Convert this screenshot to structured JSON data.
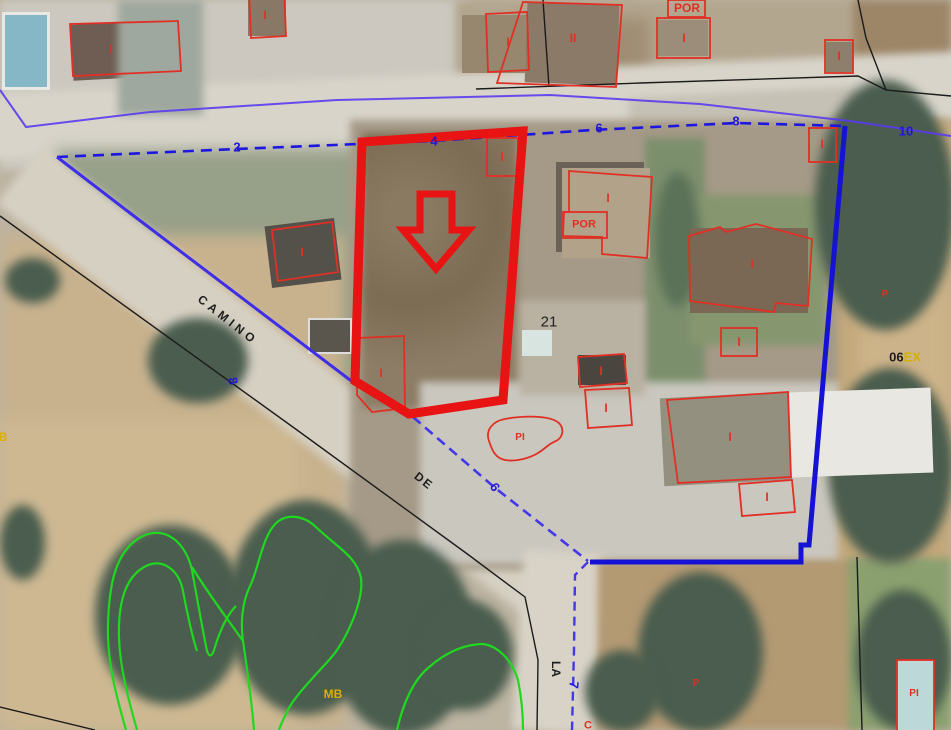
{
  "map": {
    "type": "cadastral-aerial-view",
    "selected_parcel": {
      "number": "21",
      "highlight_color": "#e81313"
    },
    "streets": {
      "camino": "CAMINO",
      "de": "DE",
      "la": "LA"
    },
    "street_numbers": {
      "n2": "2",
      "n4": "4",
      "n6": "6",
      "n8": "8",
      "n10": "10",
      "side8": "8",
      "side6": "6",
      "side7": "7"
    },
    "sector": {
      "black": "06",
      "yellow": "EX"
    },
    "land": {
      "mb_left": "MB",
      "mb_center": "MB",
      "p_east": "P",
      "p_south": "P",
      "c_south": "C"
    },
    "buildings": {
      "tl_house": "I",
      "top_small": "I",
      "cluster_left": "I",
      "cluster_main": "II",
      "por_top": "POR",
      "por_top_house": "I",
      "top_right_small": "I",
      "roadside_small": "I",
      "sel_top_shed": "I",
      "sel_bottom_shed": "I",
      "west_house": "I",
      "center_house": "I",
      "center_house_porch": "POR",
      "east_house": "I",
      "east_shed": "I",
      "mid_shed_a": "I",
      "mid_shed_b": "I",
      "south_house": "I",
      "south_shed": "I"
    },
    "pools": {
      "center": "PI",
      "southeast": "PI"
    },
    "colors": {
      "cadastral_red": "#e03025",
      "selection_red": "#e81313",
      "boundary_blue": "#1c16e0",
      "street_blue": "#5a3bf0",
      "vegetation_green": "#1fd81f",
      "label_yellow": "#dcae00"
    }
  }
}
